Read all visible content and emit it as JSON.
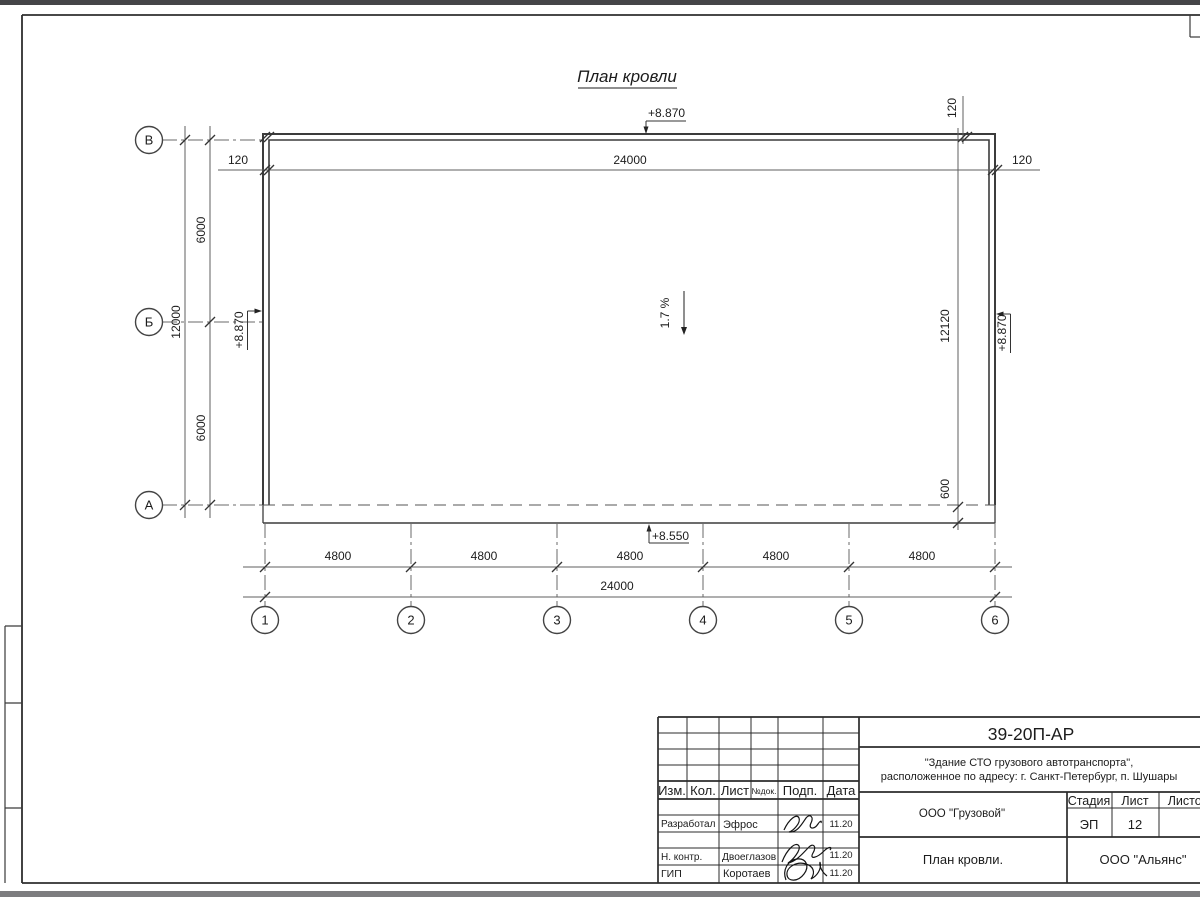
{
  "plan": {
    "title": "План кровли",
    "slope_label": "1.7 %",
    "elevations": {
      "top": "+8.870",
      "left": "+8.870",
      "right": "+8.870",
      "bottom": "+8.550"
    },
    "dims": {
      "d120": "120",
      "d24000": "24000",
      "d4800": "4800",
      "d12000": "12000",
      "d6000": "6000",
      "d12120": "12120",
      "d600": "600"
    },
    "row_axes": [
      "В",
      "Б",
      "А"
    ],
    "col_axes": [
      "1",
      "2",
      "3",
      "4",
      "5",
      "6"
    ]
  },
  "titleblock": {
    "doc_number": "39-20П-АР",
    "object_line1": "\"Здание СТО грузового автотранспорта\",",
    "object_line2": "расположенное по адресу: г. Санкт-Петербург, п. Шушары",
    "client": "ООО \"Грузовой\"",
    "sheet_title": "План кровли.",
    "company": "ООО \"Альянс\"",
    "stage_label": "Стадия",
    "sheet_label": "Лист",
    "sheets_label": "Листов",
    "stage": "ЭП",
    "sheet_number": "12",
    "columns": [
      "Изм.",
      "Кол.",
      "Лист",
      "№док.",
      "Подп.",
      "Дата"
    ],
    "rows": [
      {
        "role": "Разработал",
        "name": "Эфрос",
        "date": "11.20"
      },
      {
        "role": "Н. контр.",
        "name": "Двоеглазов",
        "date": "11.20"
      },
      {
        "role": "ГИП",
        "name": "Коротаев",
        "date": "11.20"
      }
    ]
  }
}
